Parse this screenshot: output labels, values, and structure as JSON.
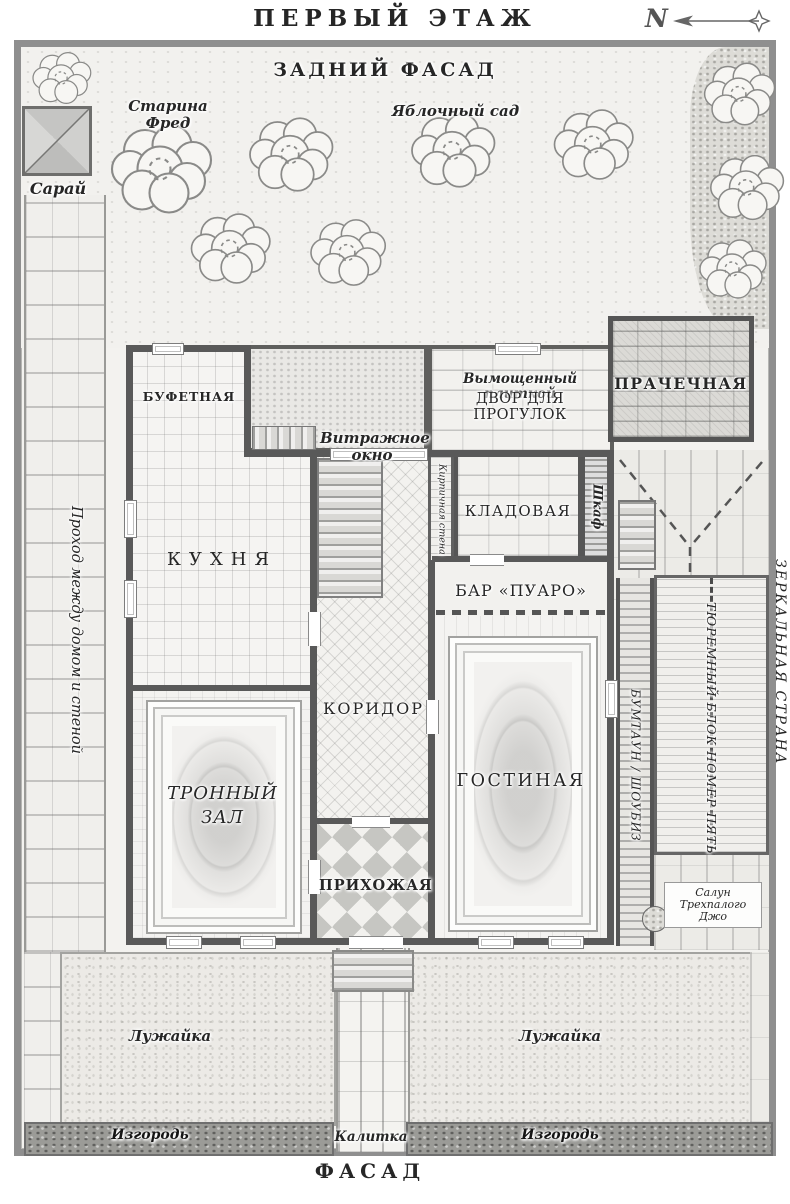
{
  "header": {
    "title": "ПЕРВЫЙ ЭТАЖ",
    "north": "N"
  },
  "labels": {
    "back_facade": "ЗАДНИЙ ФАСАД",
    "front_facade": "ФАСАД",
    "old_fred": "Старина Фред",
    "orchard": "Яблочный сад",
    "shed": "Сарай",
    "pantry": "БУФЕТНАЯ",
    "stained_window": "Витражное окно",
    "courtyard_sub": "Вымощенный плиткой",
    "courtyard": "ДВОР ДЛЯ ПРОГУЛОК",
    "laundry": "ПРАЧЕЧНАЯ",
    "kitchen": "КУХНЯ",
    "storeroom": "КЛАДОВАЯ",
    "cupboard": "Шкаф",
    "brick_wall": "Кирпичная стена",
    "bar": "БАР «ПУАРО»",
    "corridor": "КОРИДОР",
    "living_room": "ГОСТИНАЯ",
    "throne_room": "ТРОННЫЙ ЗАЛ",
    "hallway": "ПРИХОЖАЯ",
    "side_passage": "Проход между домом и стеной",
    "mirror_land": "ЗЕРКАЛЬНАЯ СТРАНА",
    "boomtown": "БУМТАУН / ШОУБИЗ",
    "prison_block": "ТЮРЕМНЫЙ БЛОК НОМЕР ПЯТЬ",
    "saloon": "Салун Трехпалого Джо",
    "lawn_left": "Лужайка",
    "lawn_right": "Лужайка",
    "hedge_left": "Изгородь",
    "hedge_right": "Изгородь",
    "gate": "Калитка"
  },
  "colors": {
    "ink": "#2b2b2b",
    "wall": "#595959",
    "frame": "#8f8f8f",
    "ground": "#f3f2ef"
  }
}
